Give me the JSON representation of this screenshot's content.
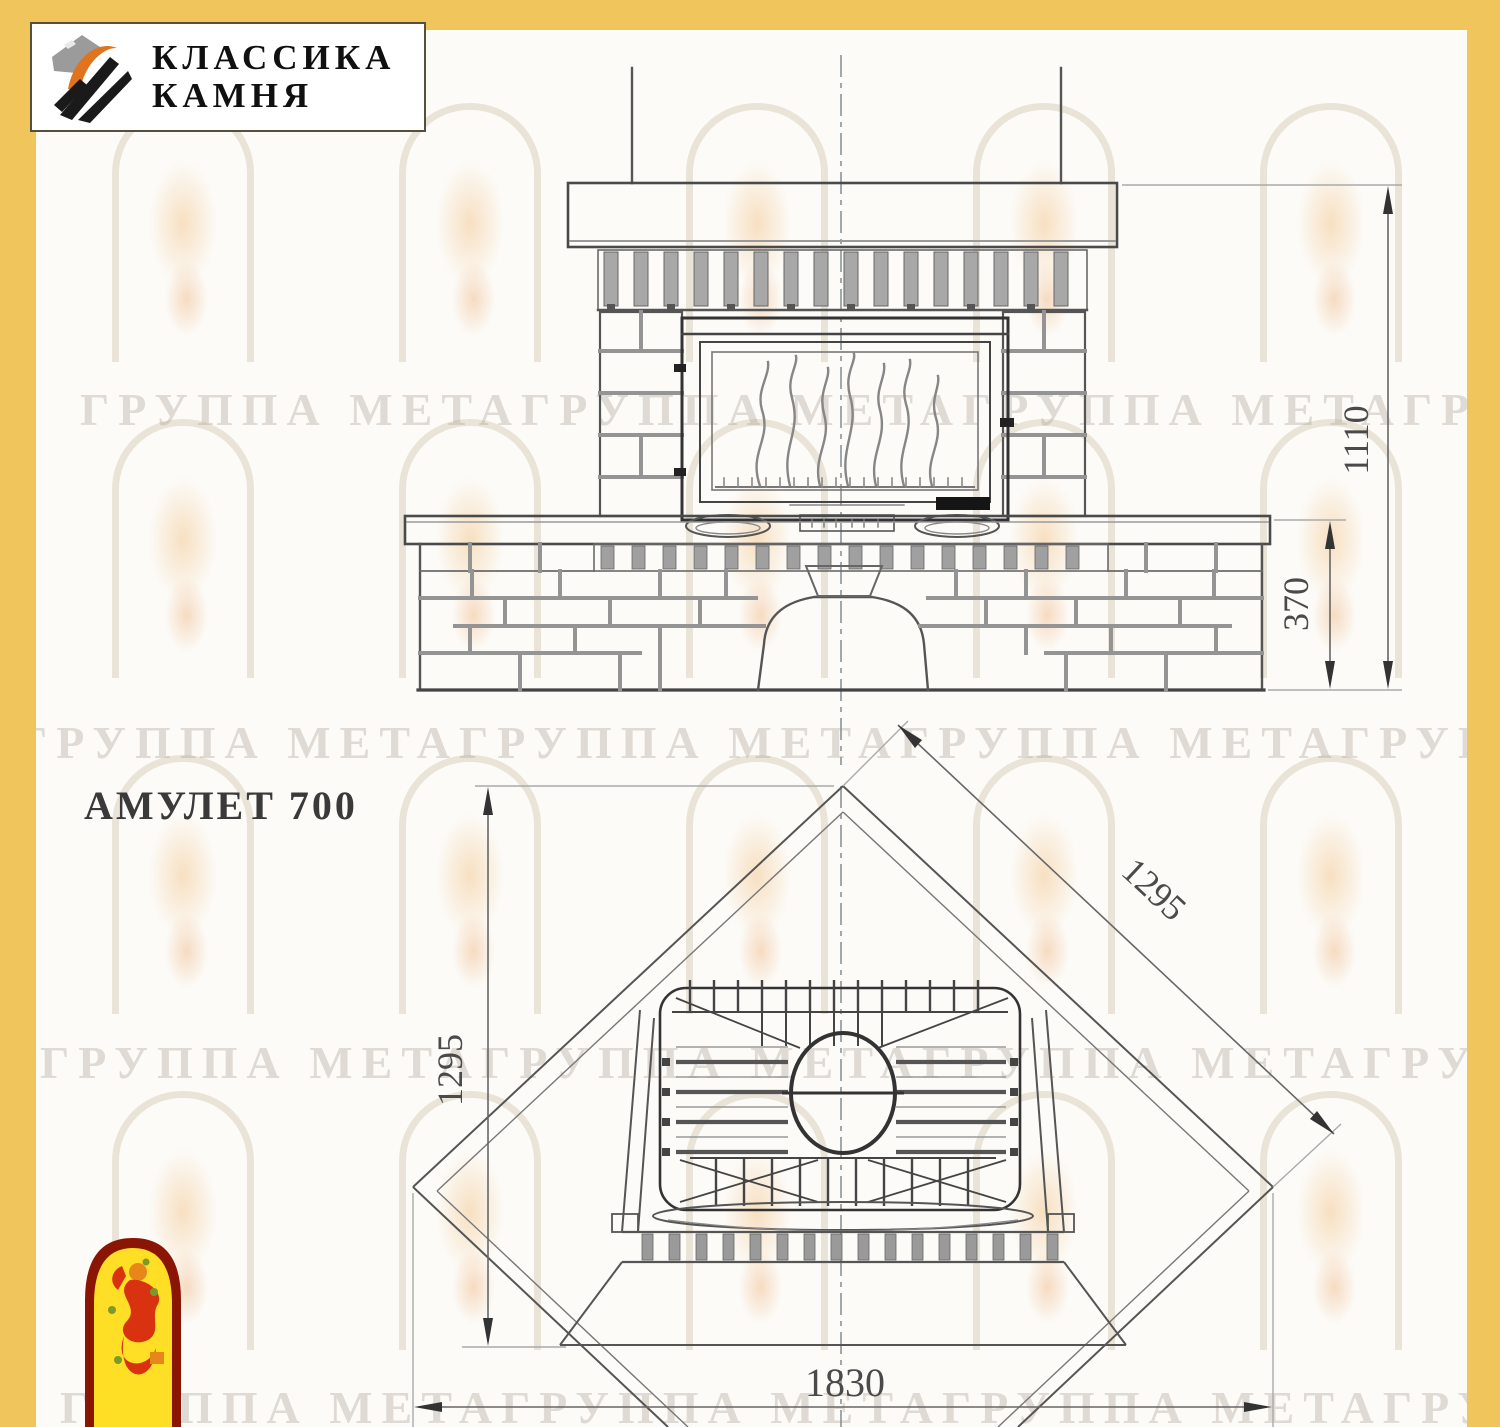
{
  "page": {
    "background": "#fcfbf8",
    "band_color": "#f0c55c"
  },
  "logo": {
    "line1": "КЛАССИКА",
    "line2": "КАМНЯ"
  },
  "title": "АМУЛЕТ 700",
  "watermark_text": "ГРУППА МЕТАГРУППА МЕТАГРУППА МЕТАГРУППА МЕТА",
  "drawing": {
    "dimensions": {
      "overall_height": "1110",
      "plinth_height": "370",
      "plan_depth": "1295",
      "plan_diagonal": "1295",
      "overall_width": "1830"
    }
  }
}
